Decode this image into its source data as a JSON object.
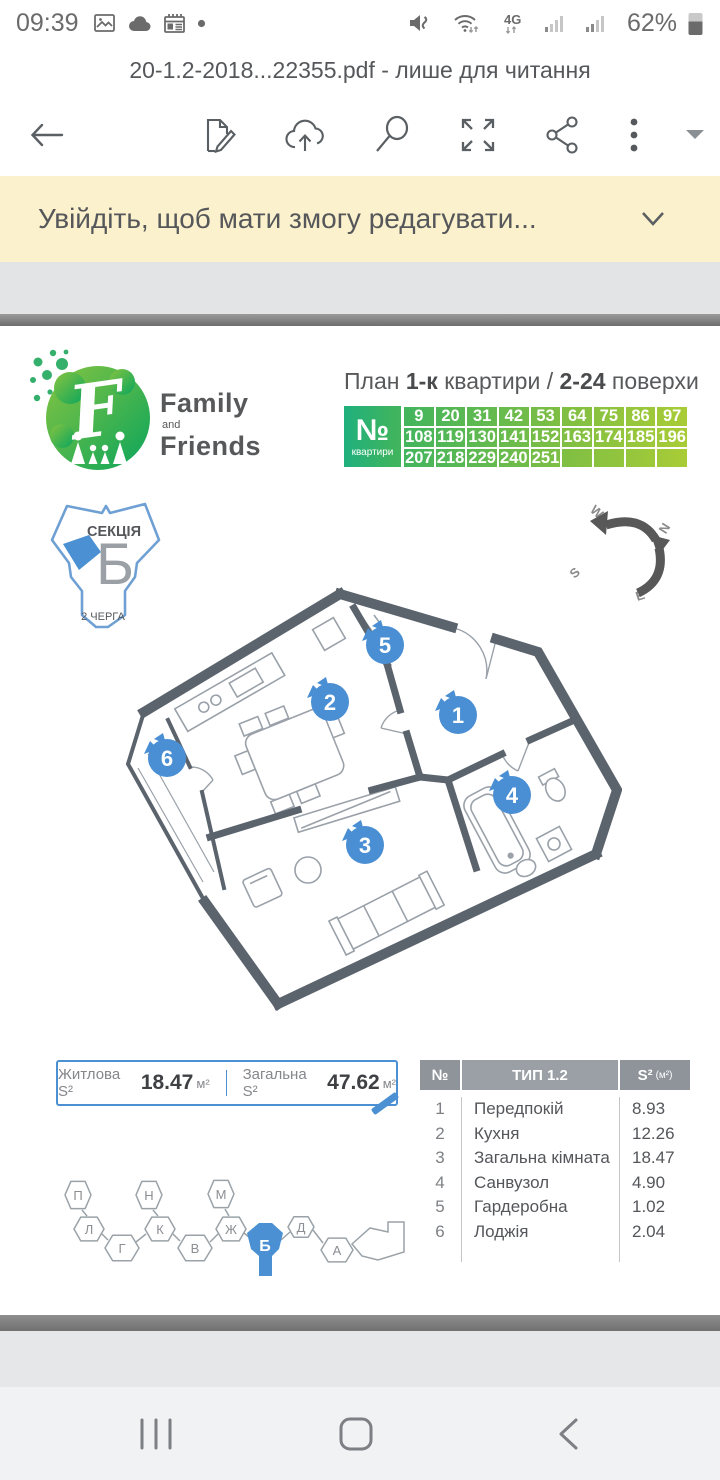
{
  "colors": {
    "accent_blue": "#4a90d2",
    "banner_bg": "#fbf1cc",
    "wall_gray": "#5b636d",
    "green_start": "#1fb07e",
    "green_end": "#a9cc36",
    "table_header_gray": "#9aa0a5"
  },
  "status_bar": {
    "time": "09:39",
    "network": "4G",
    "battery_pct": "62%"
  },
  "title_bar": {
    "filename": "20-1.2-2018...22355.pdf - лише для читання"
  },
  "banner": {
    "message": "Увійдіть, щоб мати змогу редагувати..."
  },
  "document": {
    "brand": {
      "name_top": "Family",
      "name_mid": "and",
      "name_bottom": "Friends"
    },
    "plan_title": {
      "t1": "План ",
      "b1": "1-к",
      "t2": " квартири",
      "t3": " / ",
      "b2": "2-24",
      "t4": " поверхи"
    },
    "apartments": {
      "corner_no": "№",
      "corner_label": "квартири",
      "rows": [
        [
          "9",
          "20",
          "31",
          "42",
          "53",
          "64",
          "75",
          "86",
          "97"
        ],
        [
          "108",
          "119",
          "130",
          "141",
          "152",
          "163",
          "174",
          "185",
          "196"
        ],
        [
          "207",
          "218",
          "229",
          "240",
          "251",
          "",
          "",
          "",
          ""
        ]
      ]
    },
    "section_badge": {
      "title": "СЕКЦІЯ",
      "letter": "Б",
      "phase": "2 ЧЕРГА"
    },
    "compass": {
      "w": "W",
      "n": "N",
      "s": "S",
      "e": "E"
    },
    "floorplan": {
      "markers": [
        "1",
        "2",
        "3",
        "4",
        "5",
        "6"
      ]
    },
    "area_summary": {
      "living_label": "Житлова S²",
      "living_value": "18.47",
      "living_unit": "м²",
      "total_label": "Загальна S²",
      "total_value": "47.62",
      "total_unit": "м²"
    },
    "room_table": {
      "col_no": "№",
      "col_type": "ТИП 1.2",
      "col_area": "S²",
      "col_area_unit": "(м²)",
      "rows": [
        [
          "1",
          "Передпокій",
          "8.93"
        ],
        [
          "2",
          "Кухня",
          "12.26"
        ],
        [
          "3",
          "Загальна кімната",
          "18.47"
        ],
        [
          "4",
          "Санвузол",
          "4.90"
        ],
        [
          "5",
          "Гардеробна",
          "1.02"
        ],
        [
          "6",
          "Лоджія",
          "2.04"
        ]
      ]
    },
    "sections_map": {
      "labels": [
        "П",
        "Л",
        "Г",
        "Н",
        "К",
        "В",
        "М",
        "Ж",
        "Б",
        "Д",
        "А"
      ],
      "highlighted": "Б"
    }
  }
}
